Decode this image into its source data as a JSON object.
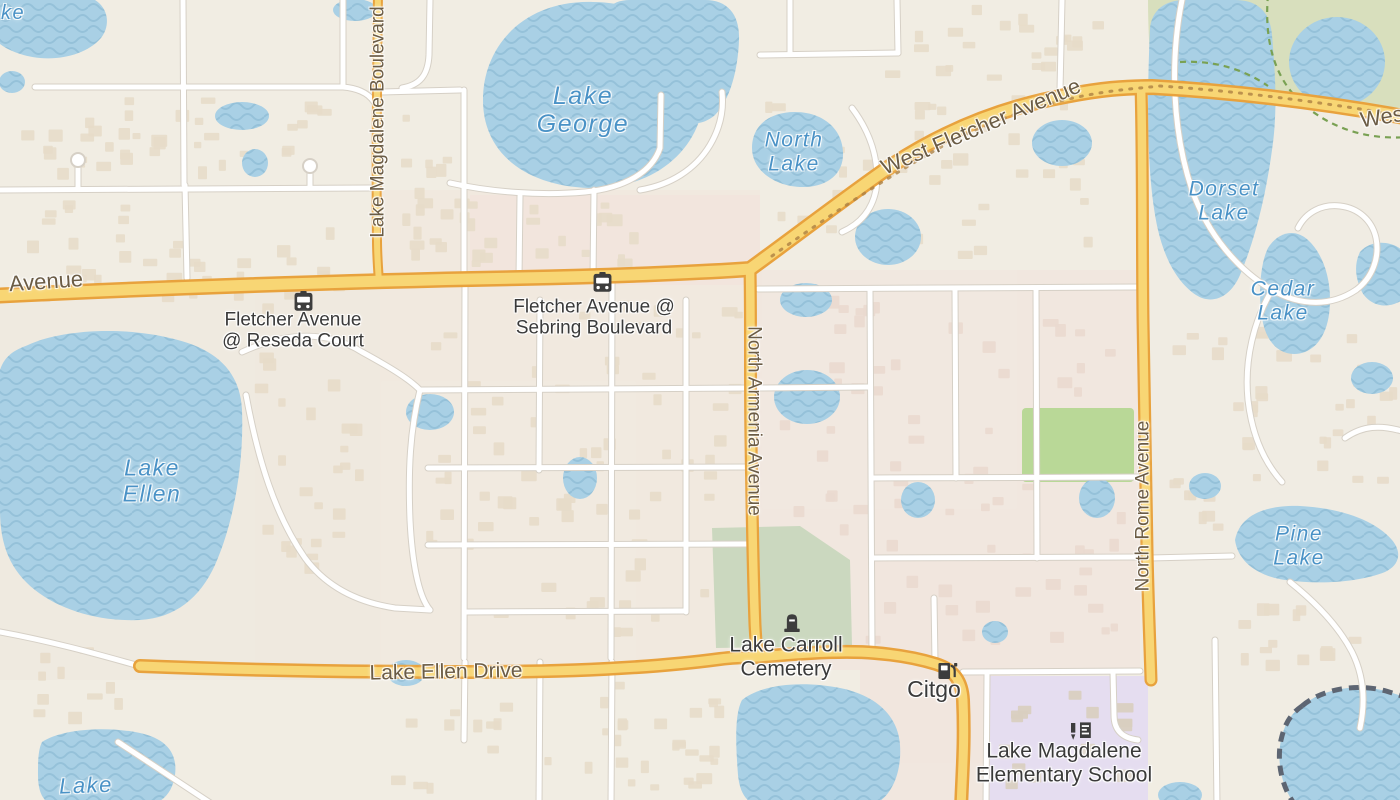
{
  "map": {
    "colors": {
      "bg": "#f1ede3",
      "water": "#a9d0e5",
      "water-wave": "#95c1d9",
      "lake-text": "#4a92c6",
      "road-fill": "#f8d674",
      "road-casing": "#e8a23d",
      "road-text": "#6b5c45",
      "minor-casing": "#d6d0c6",
      "poi-text": "#3a3a3a",
      "poi-icon": "#3d3d3d",
      "park": "#d8dfbd",
      "grass": "#b9d897",
      "cemetery": "#cbd8bf",
      "school-area": "#e5ddf0",
      "building": "#e7dbc9"
    },
    "labels": {
      "lakes": [
        {
          "lines": [
            "Lake",
            "George"
          ],
          "x": 583,
          "y": 110,
          "size": 25,
          "rotate": 0
        },
        {
          "lines": [
            "North",
            "Lake"
          ],
          "x": 794,
          "y": 152,
          "size": 21,
          "rotate": 0
        },
        {
          "lines": [
            "Dorset",
            "Lake"
          ],
          "x": 1224,
          "y": 201,
          "size": 21,
          "rotate": 0
        },
        {
          "lines": [
            "Cedar",
            "Lake"
          ],
          "x": 1283,
          "y": 301,
          "size": 21,
          "rotate": 0
        },
        {
          "lines": [
            "Lake",
            "Ellen"
          ],
          "x": 152,
          "y": 481,
          "size": 23,
          "rotate": 0
        },
        {
          "lines": [
            "Pine",
            "Lake"
          ],
          "x": 1299,
          "y": 546,
          "size": 21,
          "rotate": 0
        },
        {
          "lines": [
            "Lake"
          ],
          "x": 86,
          "y": 786,
          "size": 22,
          "rotate": -2
        },
        {
          "lines": [
            "ke"
          ],
          "x": 13,
          "y": 13,
          "size": 20,
          "rotate": 0
        }
      ],
      "roads": [
        {
          "lines": [
            "West Fletcher Avenue"
          ],
          "x": 981,
          "y": 127,
          "size": 22,
          "rotate": -23
        },
        {
          "lines": [
            "West"
          ],
          "x": 1385,
          "y": 117,
          "size": 22,
          "rotate": -9
        },
        {
          "lines": [
            "Avenue"
          ],
          "x": 46,
          "y": 282,
          "size": 22,
          "rotate": -4
        },
        {
          "lines": [
            "Lake Magdalene Boulevard"
          ],
          "x": 378,
          "y": 122,
          "size": 19,
          "rotate": -90
        },
        {
          "lines": [
            "North Armenia Avenue"
          ],
          "x": 754,
          "y": 421,
          "size": 19,
          "rotate": 90
        },
        {
          "lines": [
            "North Rome Avenue"
          ],
          "x": 1143,
          "y": 506,
          "size": 19,
          "rotate": -90
        },
        {
          "lines": [
            "Lake Ellen Drive"
          ],
          "x": 446,
          "y": 672,
          "size": 21,
          "rotate": -1
        }
      ],
      "pois": [
        {
          "lines": [
            "Fletcher Avenue",
            "@ Reseda Court"
          ],
          "label": {
            "x": 293,
            "y": 331,
            "size": 19
          },
          "icon": {
            "x": 293,
            "y": 291
          },
          "icon_name": "bus"
        },
        {
          "lines": [
            "Fletcher Avenue @",
            "Sebring Boulevard"
          ],
          "label": {
            "x": 594,
            "y": 318,
            "size": 19
          },
          "icon": {
            "x": 592,
            "y": 272
          },
          "icon_name": "bus"
        },
        {
          "lines": [
            "Lake Carroll",
            "Cemetery"
          ],
          "label": {
            "x": 786,
            "y": 657,
            "size": 21
          },
          "icon": {
            "x": 783,
            "y": 611
          },
          "icon_name": "grave"
        },
        {
          "lines": [
            "Citgo"
          ],
          "label": {
            "x": 934,
            "y": 690,
            "size": 23
          },
          "icon": {
            "x": 936,
            "y": 661
          },
          "icon_name": "fuel"
        },
        {
          "lines": [
            "Lake Magdalene",
            "Elementary School"
          ],
          "label": {
            "x": 1064,
            "y": 763,
            "size": 21
          },
          "icon": {
            "x": 1068,
            "y": 722
          },
          "icon_name": "school"
        }
      ]
    }
  }
}
